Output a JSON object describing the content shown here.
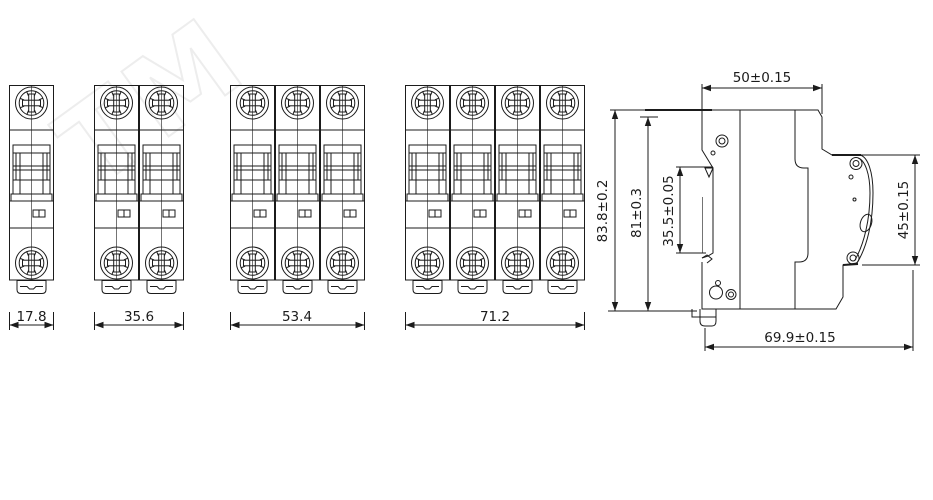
{
  "drawing": {
    "title": "MCB circuit breaker dimensional drawing",
    "background_color": "#ffffff",
    "line_color": "#1b1b1b",
    "watermark": {
      "text": "TM",
      "color": "#ededed"
    }
  },
  "front_views": [
    {
      "poles": 1,
      "width_label": "17.8"
    },
    {
      "poles": 2,
      "width_label": "35.6"
    },
    {
      "poles": 3,
      "width_label": "53.4"
    },
    {
      "poles": 4,
      "width_label": "71.2"
    }
  ],
  "side_view": {
    "top_width": "50±0.15",
    "overall_height": "83.8±0.2",
    "body_height": "81±0.3",
    "din_slot_height": "35.5±0.05",
    "front_height": "45±0.15",
    "overall_depth": "69.9±0.15"
  }
}
